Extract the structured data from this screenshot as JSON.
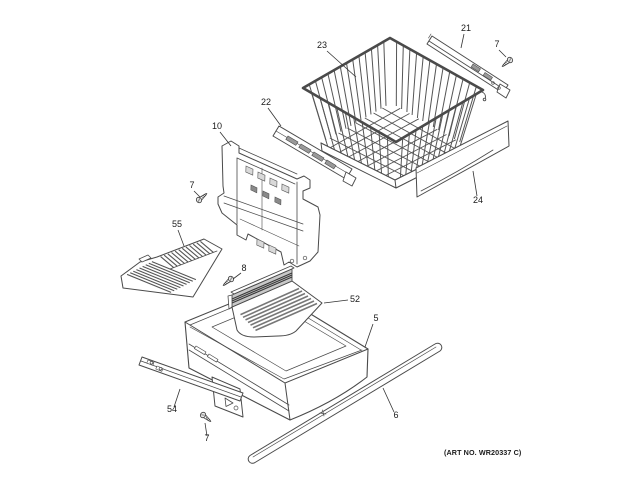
{
  "diagram": {
    "art_no": "(ART NO. WR20337 C)",
    "accent_line_color": "#4a4a4a",
    "background_color": "#ffffff",
    "callouts": {
      "basket": "23",
      "top_slide_rail": "21",
      "top_screw": "7",
      "mid_slide_rail": "22",
      "bracket": "10",
      "left_screw": "7",
      "grille": "55",
      "center_screw": "8",
      "shelf_insert": "52",
      "drawer_pan": "5",
      "front_panel": "24",
      "lower_slide_rail": "54",
      "lower_screw": "7",
      "long_rail": "6"
    }
  }
}
